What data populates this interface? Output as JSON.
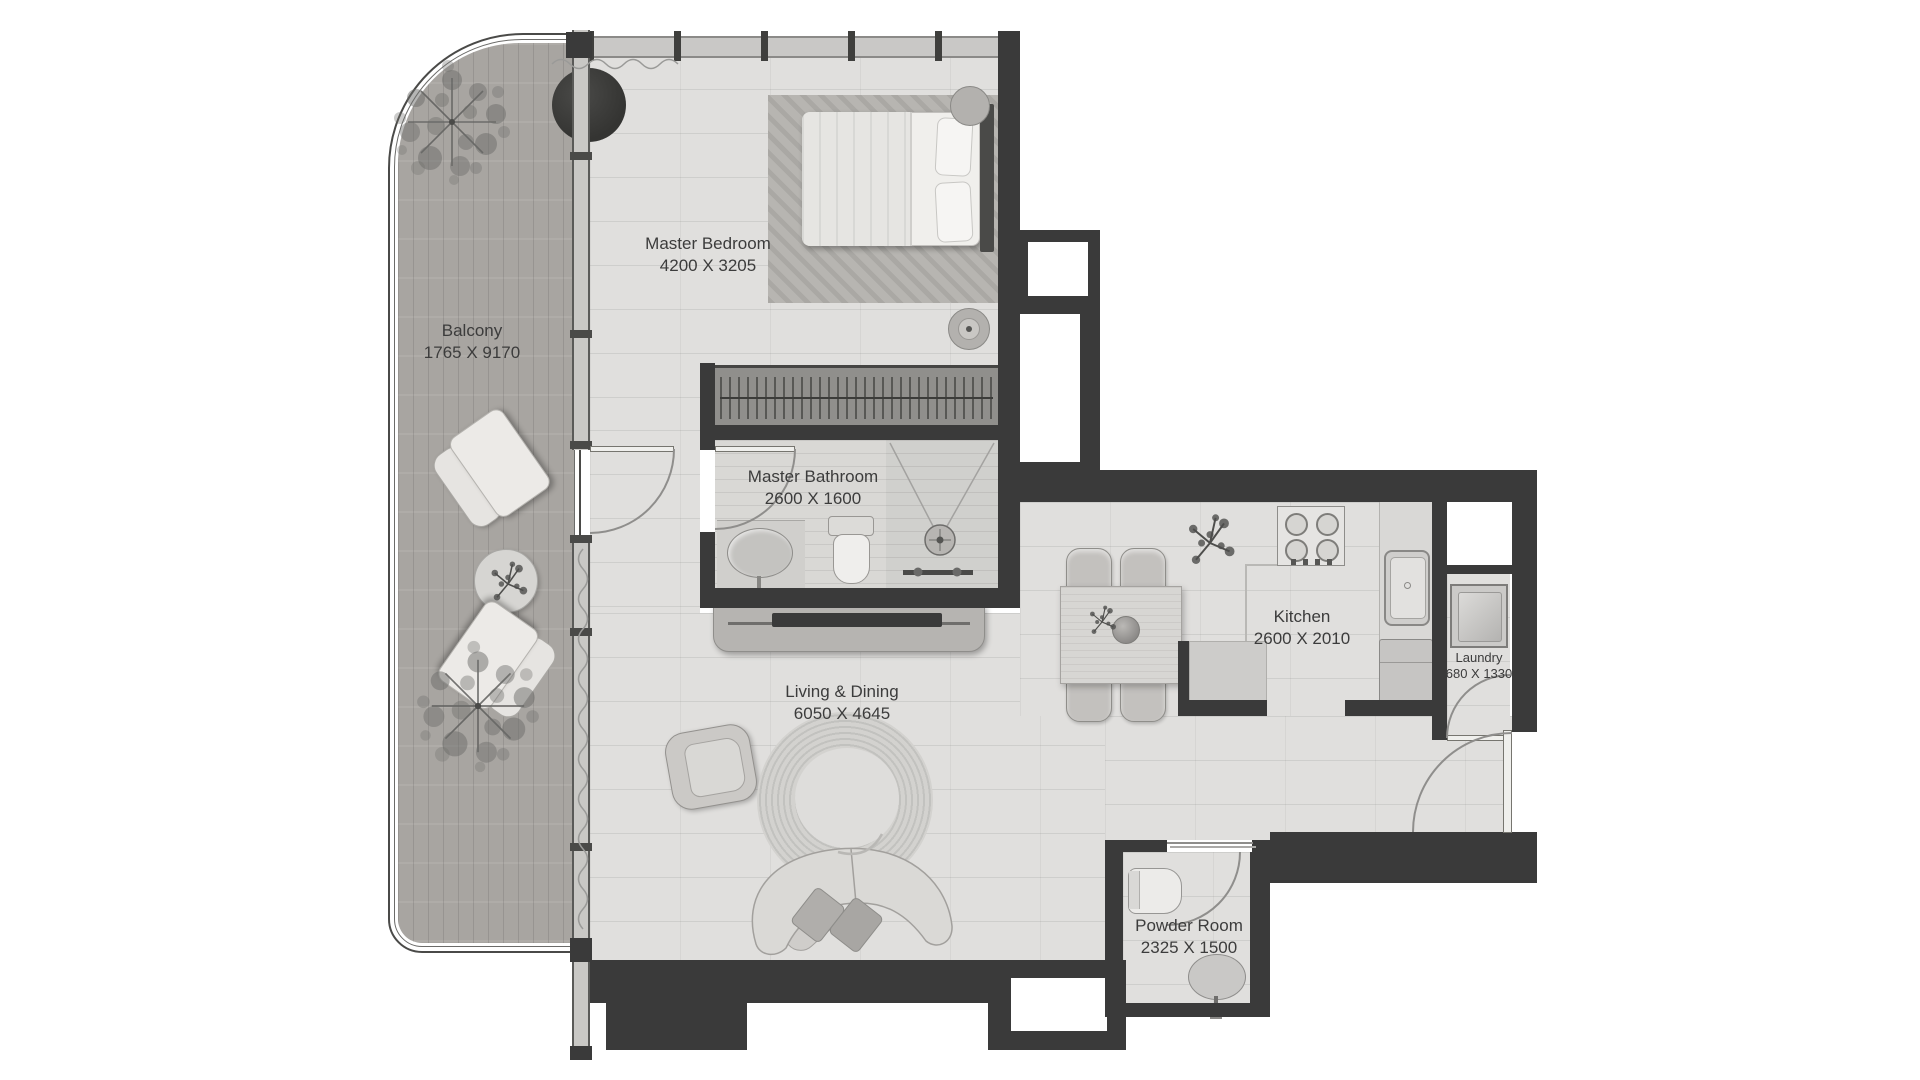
{
  "title": "Apartment Floor Plan",
  "rooms": [
    {
      "id": "balcony",
      "name": "Balcony",
      "dims": "1765 X 9170"
    },
    {
      "id": "master-bedroom",
      "name": "Master Bedroom",
      "dims": "4200 X 3205"
    },
    {
      "id": "master-bathroom",
      "name": "Master Bathroom",
      "dims": "2600 X 1600"
    },
    {
      "id": "kitchen",
      "name": "Kitchen",
      "dims": "2600 X 2010"
    },
    {
      "id": "laundry",
      "name": "Laundry",
      "dims": "680 X 1330"
    },
    {
      "id": "living-dining",
      "name": "Living & Dining",
      "dims": "6050 X 4645"
    },
    {
      "id": "powder-room",
      "name": "Powder Room",
      "dims": "2325 X 1500"
    }
  ],
  "colors": {
    "wall": "#3a3a3a",
    "floor": "#e0dfdd",
    "balcony_wood": "#a8a5a1",
    "glass_wall": "#c9c8c5",
    "label_text": "#3c3c3c",
    "background": "#ffffff"
  },
  "fixtures": [
    "bed",
    "wardrobe",
    "bathroom-sink",
    "toilet",
    "shower",
    "tv-console",
    "armchair",
    "round-rug",
    "curved-sofa",
    "dining-table",
    "dining-chairs",
    "stove",
    "kitchen-sink",
    "fridge",
    "kitchen-island",
    "washing-machine",
    "powder-toilet",
    "powder-sink",
    "lounge-chairs",
    "balcony-table",
    "trees",
    "entry-door",
    "balcony-door",
    "curtains"
  ]
}
